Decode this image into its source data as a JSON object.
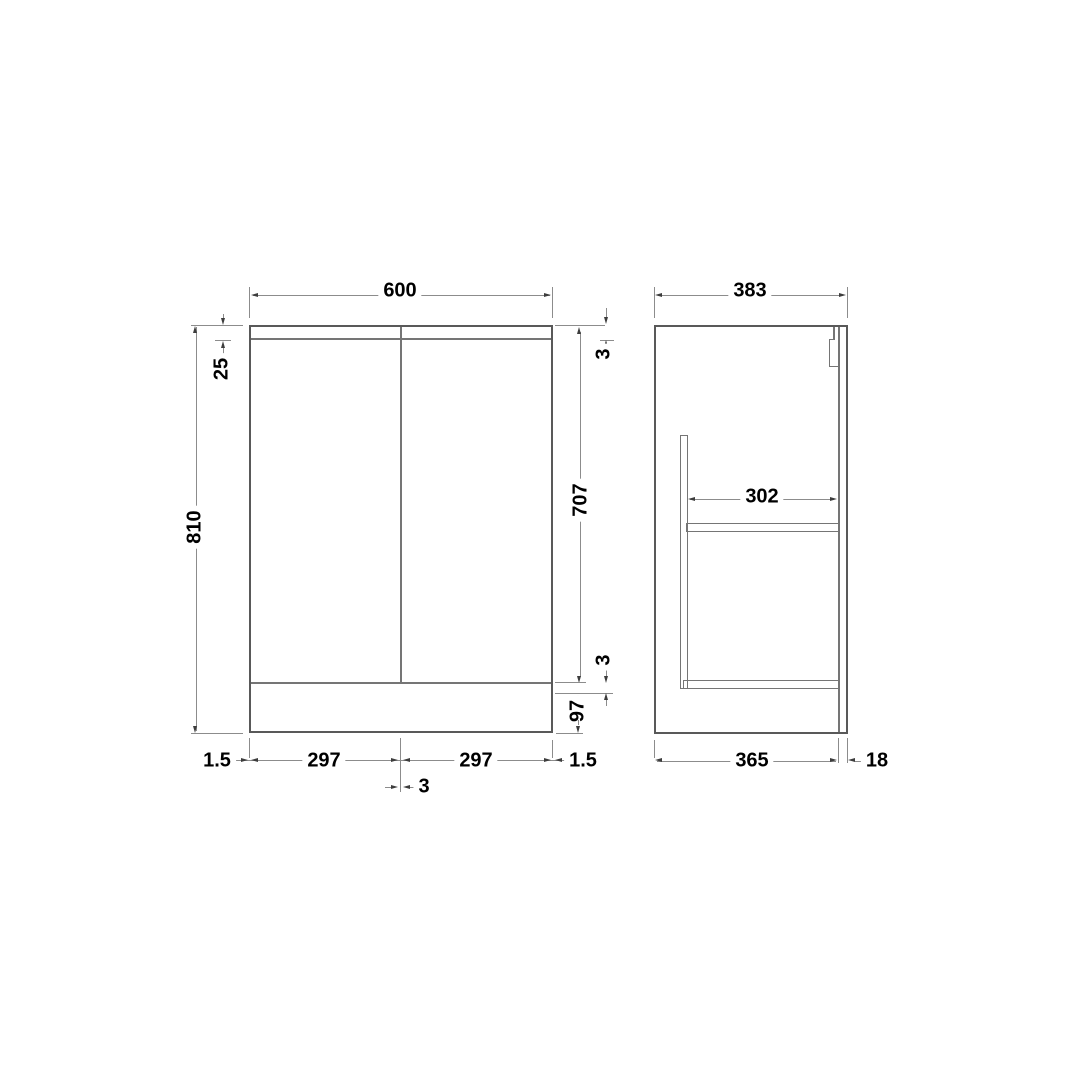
{
  "colors": {
    "background": "#ffffff",
    "outline": "#595959",
    "inner_line": "#757575",
    "dim_line": "#8c8c8c",
    "arrow": "#3d3d3d",
    "text": "#000000"
  },
  "drawing": {
    "type": "technical-dimension-drawing",
    "front": {
      "overall_width": "600",
      "overall_height": "810",
      "top_panel": "25",
      "top_gap": "3",
      "door_height": "707",
      "bottom_gap": "3",
      "plinth_height": "97",
      "left_margin": "1.5",
      "left_door_width": "297",
      "centre_gap": "3",
      "right_door_width": "297",
      "right_margin": "1.5"
    },
    "side": {
      "overall_depth": "383",
      "internal_depth": "302",
      "carcass_depth": "365",
      "door_thickness": "18"
    }
  }
}
